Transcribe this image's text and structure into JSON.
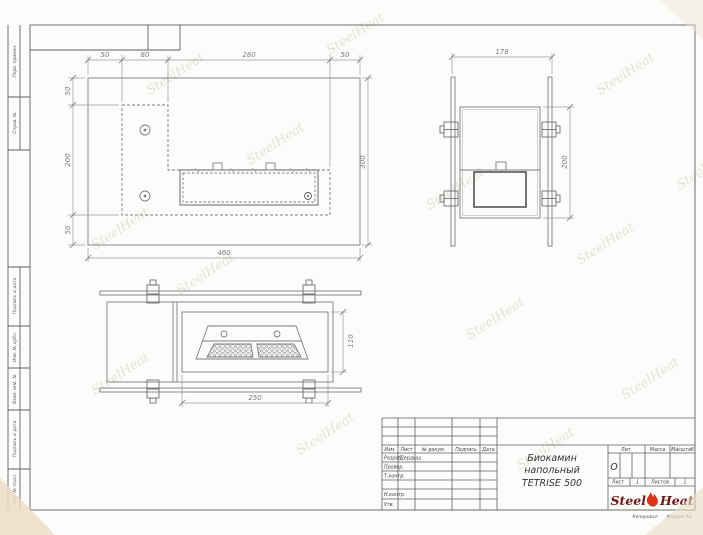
{
  "watermark": "SteelHeat",
  "frame": {
    "left_strip_labels": [
      "Перв. примен.",
      "Справ. №",
      "Подпись и дата",
      "Инв. № дубл.",
      "Взам. инв. №",
      "Подпись и дата",
      "Инв. № подл."
    ],
    "footer": {
      "copied": "Копировал",
      "format": "Формат А3"
    }
  },
  "views": {
    "front": {
      "dims_top": [
        "50",
        "80",
        "280",
        "50"
      ],
      "dims_left": [
        "50",
        "200",
        "50"
      ],
      "dim_bottom": "460",
      "dim_right": "300"
    },
    "side": {
      "dim_top": "178",
      "dim_right": "200"
    },
    "top": {
      "dim_bottom": "250",
      "dim_right": "110"
    }
  },
  "title_block": {
    "columns": [
      "Изм.",
      "Лист",
      "№ докум.",
      "Подпись",
      "Дата"
    ],
    "rows": [
      {
        "label": "Разраб.",
        "name": "Дердыш"
      },
      {
        "label": "Провер.",
        "name": ""
      },
      {
        "label": "Т.контр.",
        "name": ""
      },
      {
        "label": "",
        "name": ""
      },
      {
        "label": "Н.контр.",
        "name": ""
      },
      {
        "label": "Утв.",
        "name": ""
      }
    ],
    "title_line1": "Биокамин",
    "title_line2": "напольный",
    "title_line3": "TETRISE 500",
    "lit_label": "Лит.",
    "lit_value": "О",
    "mass_label": "Масса",
    "scale_label": "Масштаб",
    "sheet_label": "Лист",
    "sheet_value": "1",
    "sheets_label": "Листов",
    "sheets_value": "1",
    "logo": {
      "steel": "Steel",
      "heat": "Heat"
    }
  },
  "colors": {
    "line": "#7d7d7d",
    "frame": "#5f5f5f",
    "logo_text": "#6e1616",
    "flame": "#e03214",
    "paper": "#fcfcfa"
  }
}
